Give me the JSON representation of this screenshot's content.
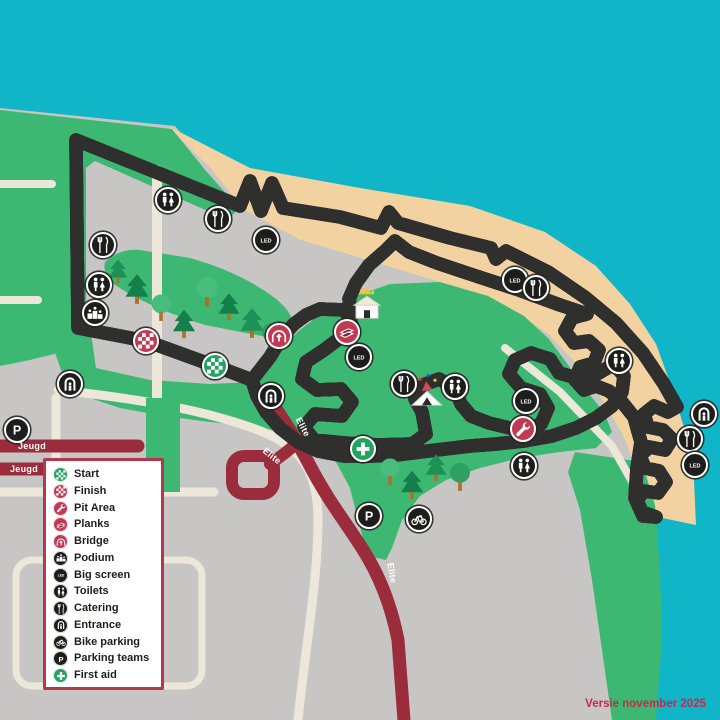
{
  "map": {
    "version_label": "Versie november 2025",
    "colors": {
      "water": "#11b5c8",
      "beach": "#f3d2a2",
      "grass": "#3cb873",
      "pavement": "#c7c6c4",
      "road_beige": "#ece7d9",
      "road_darkred": "#9b2c3c",
      "course_red": "#d8455c",
      "marker_black": "#1d1d1b",
      "marker_crimson": "#c23a52",
      "marker_green": "#23a35f"
    },
    "road_labels": [
      {
        "text": "Jeugd",
        "x": 32,
        "y": 446,
        "rot": 0
      },
      {
        "text": "Jeugd",
        "x": 24,
        "y": 469,
        "rot": 0
      },
      {
        "text": "Elite",
        "x": 303,
        "y": 427,
        "rot": 62
      },
      {
        "text": "Elite",
        "x": 272,
        "y": 456,
        "rot": 38
      },
      {
        "text": "Elite",
        "x": 392,
        "y": 573,
        "rot": 80
      }
    ],
    "markers": [
      {
        "type": "toilets",
        "x": 168,
        "y": 200
      },
      {
        "type": "catering",
        "x": 218,
        "y": 219
      },
      {
        "type": "catering",
        "x": 103,
        "y": 245
      },
      {
        "type": "toilets",
        "x": 99,
        "y": 285
      },
      {
        "type": "podium",
        "x": 95,
        "y": 313
      },
      {
        "type": "finish",
        "x": 146,
        "y": 341
      },
      {
        "type": "start",
        "x": 215,
        "y": 366
      },
      {
        "type": "entrance",
        "x": 70,
        "y": 384
      },
      {
        "type": "parking",
        "x": 17,
        "y": 430
      },
      {
        "type": "bigscreen",
        "x": 266,
        "y": 240
      },
      {
        "type": "bridge",
        "x": 279,
        "y": 336
      },
      {
        "type": "planks",
        "x": 347,
        "y": 332
      },
      {
        "type": "bigscreen",
        "x": 359,
        "y": 357
      },
      {
        "type": "entrance",
        "x": 271,
        "y": 396
      },
      {
        "type": "catering",
        "x": 404,
        "y": 384
      },
      {
        "type": "toilets",
        "x": 455,
        "y": 387
      },
      {
        "type": "bigscreen",
        "x": 515,
        "y": 280
      },
      {
        "type": "catering",
        "x": 536,
        "y": 288
      },
      {
        "type": "bigscreen",
        "x": 526,
        "y": 401
      },
      {
        "type": "pit",
        "x": 523,
        "y": 429
      },
      {
        "type": "toilets",
        "x": 524,
        "y": 466
      },
      {
        "type": "toilets",
        "x": 619,
        "y": 361
      },
      {
        "type": "firstaid",
        "x": 363,
        "y": 449
      },
      {
        "type": "parking",
        "x": 369,
        "y": 516
      },
      {
        "type": "bikeparking",
        "x": 419,
        "y": 519
      },
      {
        "type": "entrance",
        "x": 704,
        "y": 414
      },
      {
        "type": "catering",
        "x": 690,
        "y": 439
      },
      {
        "type": "bigscreen",
        "x": 695,
        "y": 465
      }
    ],
    "buildings": [
      {
        "type": "house-crown",
        "x": 368,
        "y": 311
      },
      {
        "type": "party-tent",
        "x": 427,
        "y": 397
      }
    ],
    "trees": [
      {
        "kind": "pine",
        "x": 118,
        "y": 276,
        "s": 0.8
      },
      {
        "kind": "pine",
        "x": 137,
        "y": 294,
        "s": 1.0
      },
      {
        "kind": "round",
        "x": 161,
        "y": 313,
        "s": 0.9
      },
      {
        "kind": "pine",
        "x": 184,
        "y": 329,
        "s": 0.95
      },
      {
        "kind": "round",
        "x": 207,
        "y": 297,
        "s": 1.0
      },
      {
        "kind": "pine",
        "x": 229,
        "y": 312,
        "s": 0.9
      },
      {
        "kind": "pine",
        "x": 252,
        "y": 328,
        "s": 1.0
      },
      {
        "kind": "round",
        "x": 271,
        "y": 341,
        "s": 0.85
      },
      {
        "kind": "round",
        "x": 390,
        "y": 477,
        "s": 0.9
      },
      {
        "kind": "pine",
        "x": 412,
        "y": 490,
        "s": 0.95
      },
      {
        "kind": "pine",
        "x": 436,
        "y": 473,
        "s": 0.9
      },
      {
        "kind": "round",
        "x": 460,
        "y": 482,
        "s": 0.95
      }
    ]
  },
  "legend": {
    "items": [
      {
        "icon": "start",
        "label": "Start"
      },
      {
        "icon": "finish",
        "label": "Finish"
      },
      {
        "icon": "pit",
        "label": "Pit Area"
      },
      {
        "icon": "planks",
        "label": "Planks"
      },
      {
        "icon": "bridge",
        "label": "Bridge"
      },
      {
        "icon": "podium",
        "label": "Podium"
      },
      {
        "icon": "bigscreen",
        "label": "Big screen"
      },
      {
        "icon": "toilets",
        "label": "Toilets"
      },
      {
        "icon": "catering",
        "label": "Catering"
      },
      {
        "icon": "entrance",
        "label": "Entrance"
      },
      {
        "icon": "bikeparking",
        "label": "Bike parking"
      },
      {
        "icon": "parking",
        "label": "Parking teams"
      },
      {
        "icon": "firstaid",
        "label": "First aid"
      }
    ]
  }
}
